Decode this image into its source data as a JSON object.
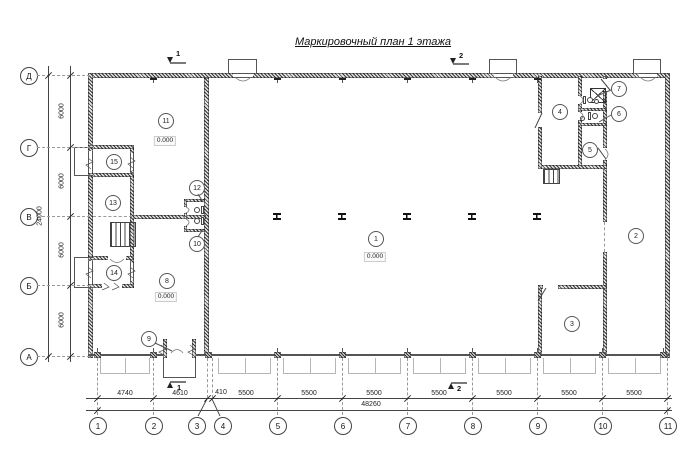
{
  "title": "Маркировочный план 1 этажа",
  "rows": [
    "Д",
    "Г",
    "В",
    "Б",
    "А"
  ],
  "cols": [
    "1",
    "2",
    "3",
    "4",
    "5",
    "6",
    "7",
    "8",
    "9",
    "10",
    "11"
  ],
  "rooms": [
    "1",
    "2",
    "3",
    "4",
    "5",
    "6",
    "7",
    "8",
    "9",
    "10",
    "11",
    "12",
    "13",
    "14",
    "15"
  ],
  "elevations": [
    "0.000",
    "0.000",
    "0.000"
  ],
  "dims_bottom": [
    "4740",
    "4610",
    "410",
    "5500",
    "5500",
    "5500",
    "5500",
    "5500",
    "5500",
    "5500"
  ],
  "dims_bottom_total": "48260",
  "dims_left": [
    "6000",
    "6000",
    "6000",
    "6000"
  ],
  "dims_left_total": "24000",
  "sections": [
    "1",
    "2"
  ]
}
